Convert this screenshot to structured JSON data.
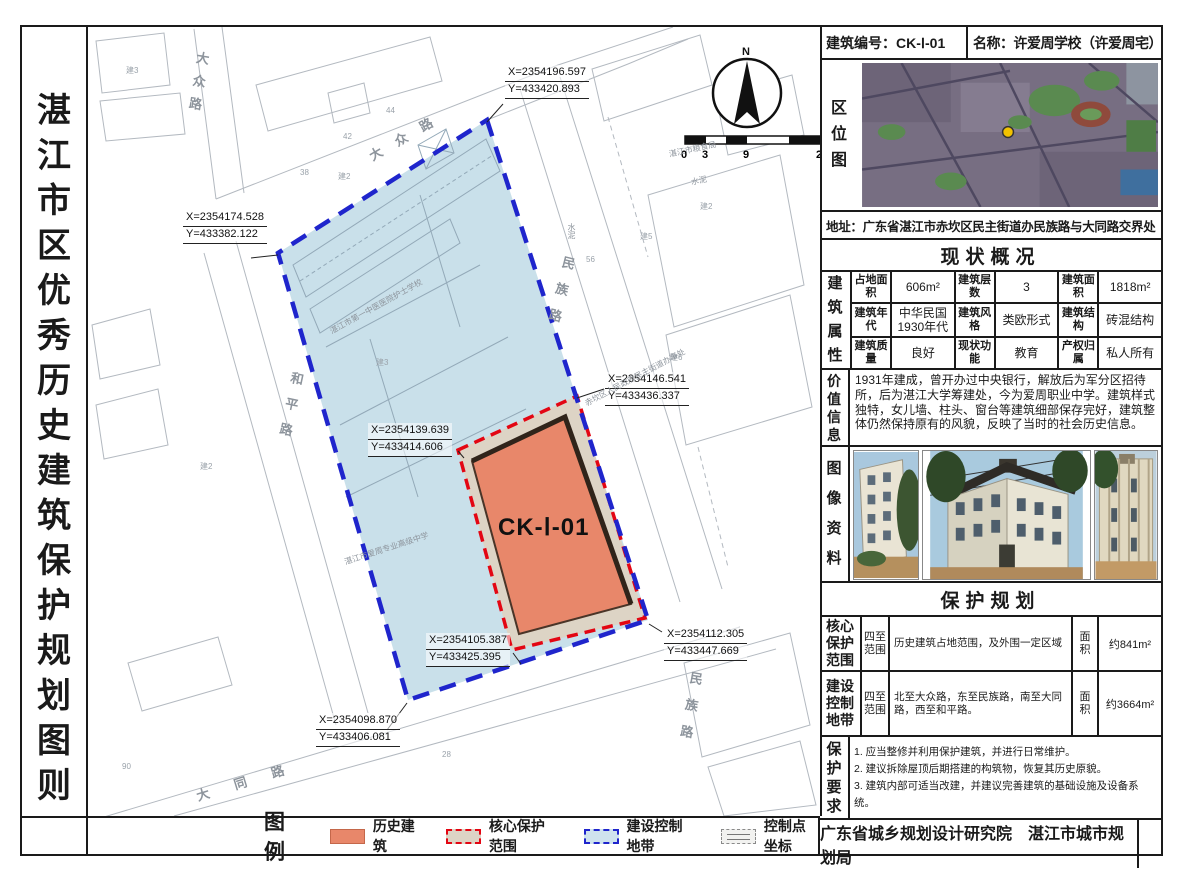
{
  "sheet": {
    "vertical_title": "湛江市区优秀历史建筑保护规划图则"
  },
  "map": {
    "core_building_label": "CK-Ⅰ-01",
    "north_label": "N",
    "scale_ticks": [
      "0",
      "3",
      "9",
      "21m"
    ],
    "streets": [
      {
        "text": "大众路"
      },
      {
        "text": "大众路"
      },
      {
        "text": "民族路"
      },
      {
        "text": "民族路"
      },
      {
        "text": "和平路"
      },
      {
        "text": "大同路"
      }
    ],
    "places": [
      "湛江市第一中医医院护士学校",
      "湛江市爱周专业高级中学",
      "赤坎区人民政府民主街道办事处",
      "湛江市粮食局",
      "水泥",
      "水泥"
    ],
    "parcel_labels": [
      "建3",
      "建2",
      "建5",
      "建6",
      "建2",
      "建3",
      "建2"
    ],
    "lot_numbers": [
      "42",
      "44",
      "38",
      "56",
      "90",
      "28"
    ],
    "coordinates": [
      {
        "x": "X=2354196.597",
        "y": "Y=433420.893"
      },
      {
        "x": "X=2354174.528",
        "y": "Y=433382.122"
      },
      {
        "x": "X=2354146.541",
        "y": "Y=433436.337"
      },
      {
        "x": "X=2354139.639",
        "y": "Y=433414.606"
      },
      {
        "x": "X=2354105.387",
        "y": "Y=433425.395"
      },
      {
        "x": "X=2354112.305",
        "y": "Y=433447.669"
      },
      {
        "x": "X=2354098.870",
        "y": "Y=433406.081"
      }
    ]
  },
  "legend": {
    "title": "图例",
    "items": [
      {
        "label": "历史建筑"
      },
      {
        "label": "核心保护范围"
      },
      {
        "label": "建设控制地带"
      },
      {
        "label": "控制点坐标"
      }
    ]
  },
  "panel": {
    "building_no": "建筑编号：CK-Ⅰ-01",
    "name": "名称：许爱周学校（许爱周宅）",
    "location_map_label": "区位图",
    "address": "地址：广东省湛江市赤坎区民主街道办民族路与大同路交界处",
    "status": {
      "title": "现状概况",
      "row_header": "建筑属性",
      "rows": [
        [
          {
            "label": "占地面积",
            "value": "606m²"
          },
          {
            "label": "建筑层数",
            "value": "3"
          },
          {
            "label": "建筑面积",
            "value": "1818m²"
          }
        ],
        [
          {
            "label": "建筑年代",
            "value": "中华民国1930年代"
          },
          {
            "label": "建筑风格",
            "value": "类欧形式"
          },
          {
            "label": "建筑结构",
            "value": "砖混结构"
          }
        ],
        [
          {
            "label": "建筑质量",
            "value": "良好"
          },
          {
            "label": "现状功能",
            "value": "教育"
          },
          {
            "label": "产权归属",
            "value": "私人所有"
          }
        ]
      ]
    },
    "value_info": {
      "label": "价值信息",
      "text": "1931年建成，曾开办过中央银行，解放后为军分区招待所，后为湛江大学筹建处，今为爱周职业中学。建筑样式独特，女儿墙、柱头、窗台等建筑细部保存完好，建筑整体仍然保持原有的风貌，反映了当时的社会历史信息。"
    },
    "images_label": "图像资料",
    "protection": {
      "title": "保护规划",
      "core": {
        "name": "核心保护范围",
        "range_label": "四至范围",
        "range": "历史建筑占地范围，及外围一定区域",
        "area_label": "面积",
        "area": "约841m²"
      },
      "control": {
        "name": "建设控制地带",
        "range_label": "四至范围",
        "range": "北至大众路，东至民族路，南至大同路，西至和平路。",
        "area_label": "面积",
        "area": "约3664m²"
      }
    },
    "requirements": {
      "label": "保护要求",
      "items": [
        "1. 应当整修并利用保护建筑，并进行日常维护。",
        "2. 建议拆除屋顶后期搭建的构筑物，恢复其历史原貌。",
        "3. 建筑内部可适当改建，并建议完善建筑的基础设施及设备系统。"
      ]
    },
    "footer": "广东省城乡规划设计研究院　湛江市城市规划局"
  },
  "colors": {
    "historic_fill": "#e8876a",
    "core_line": "#e30613",
    "core_fill": "#ddd4c5",
    "control_line": "#1f25cc",
    "control_fill": "#c9e0ea"
  }
}
